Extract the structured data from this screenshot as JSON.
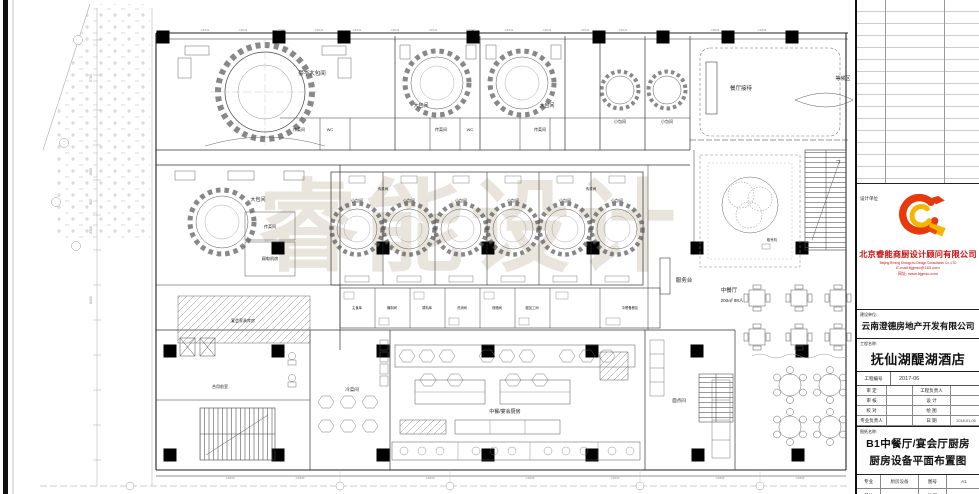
{
  "plan": {
    "watermark": "睿能设计",
    "labels": {
      "luxury_room": "豪华大包间",
      "large_room": "大包间",
      "small_room": "小包间",
      "reception": "餐厅接待",
      "waiting": "等候区",
      "pass_room": "传菜间",
      "wc": "WC",
      "weak_power_room": "弱电机房",
      "banquet_store": "宴会家具库房",
      "service_desk": "服务台",
      "number_machine": "取号机",
      "dining_hall": "中餐厅",
      "dining_capacity": "200㎡ 88人",
      "kitchen": "中餐/宴会厨房",
      "cold_dish_room": "冷菜间",
      "pastry_room": "面点间",
      "shared_lobby": "合用前室",
      "staple_store": "主食库",
      "pickle_room": "腌制间",
      "spice_store": "调料库",
      "wash_room": "洗消间",
      "roast_room": "烧腊间",
      "rough_prep_room": "粗加工间",
      "prep_area": "中餐备餐区"
    },
    "window_codes": {
      "top": "C1041",
      "top_right": "C1834",
      "bottom": "C1833"
    },
    "dimensions": [
      "5700",
      "1500",
      "900",
      "3300",
      "8400"
    ]
  },
  "title_block": {
    "design_unit_label": "设计单位",
    "company_cn": "北京睿能商厨设计顾问有限公司",
    "company_en": "Beijing Rineng Shangchu Design Consultants Co.,LTD",
    "email": "E-mail:bjgnsc@163.com",
    "website": "网址: www.bjgnsc.com",
    "client_label": "建设单位:",
    "client_name": "云南澄德房地产开发有限公司",
    "project_label": "工程名称:",
    "project_name": "抚仙湖醍湖酒店",
    "project_no_label": "工程编号",
    "project_no": "2017-06",
    "approval_rows": [
      {
        "left": "审 定",
        "right": "工程负责人",
        "right_value": ""
      },
      {
        "left": "审 核",
        "right": "设 计",
        "right_value": ""
      },
      {
        "left": "校 对",
        "right": "绘 图",
        "right_value": ""
      },
      {
        "left": "专业负责人",
        "right": "日 期",
        "right_value": "2018-01-05"
      }
    ],
    "drawing_name_label": "图纸名称:",
    "drawing_name_line1": "B1中餐厅/宴会厅厨房",
    "drawing_name_line2": "厨房设备平面布置图",
    "specialty_label": "专业",
    "specialty_value": "厨房设备",
    "sheet_no_label": "图号",
    "sheet_no_value": "A1",
    "unit_label": "单位",
    "unit_value": "mm",
    "scale_label": "比例",
    "scale_value": "1:100"
  }
}
